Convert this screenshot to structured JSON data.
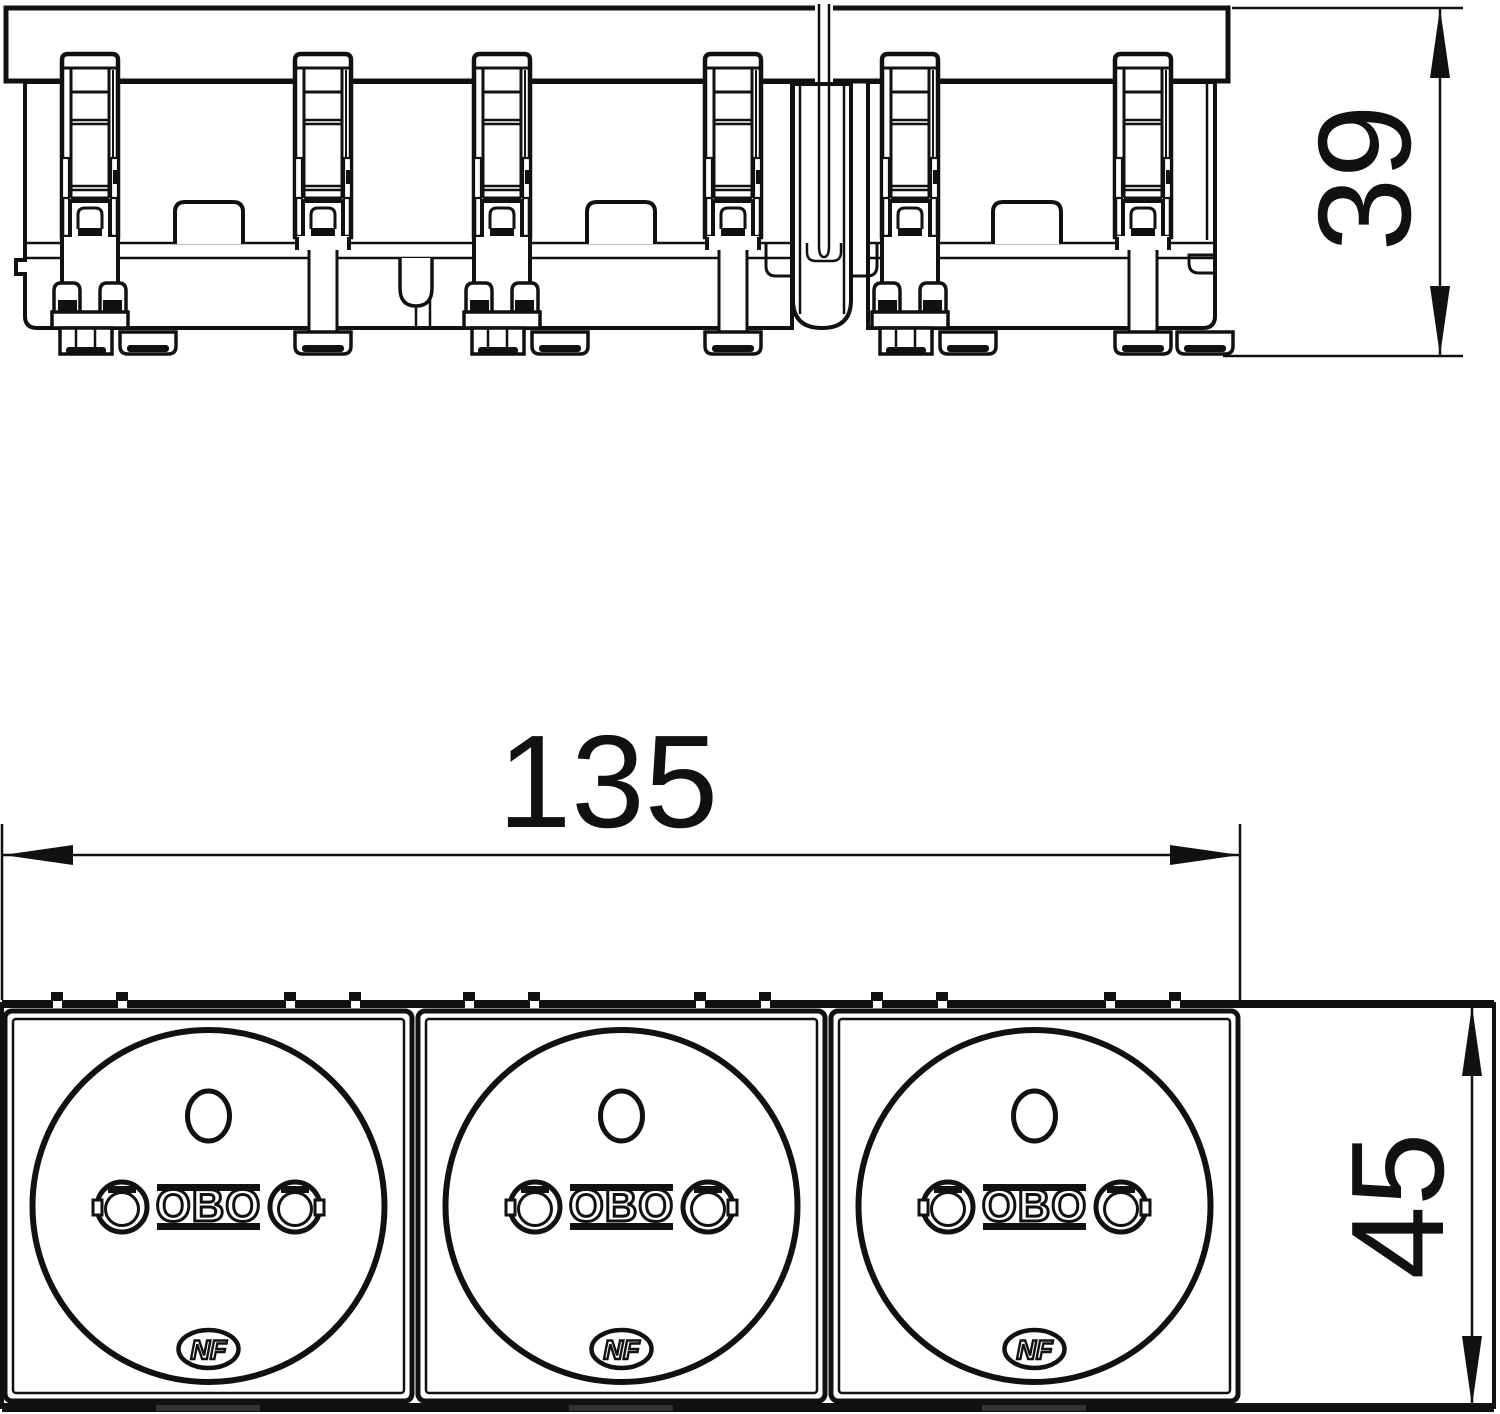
{
  "drawing": {
    "dim_height_top_view": "39",
    "dim_width_overall": "135",
    "dim_height_front_view": "45"
  },
  "socket": {
    "brand_mark": "OBO",
    "cert_mark": "NF"
  },
  "colors": {
    "line": "#111111",
    "background": "#ffffff",
    "foot_accent": "#333333"
  }
}
